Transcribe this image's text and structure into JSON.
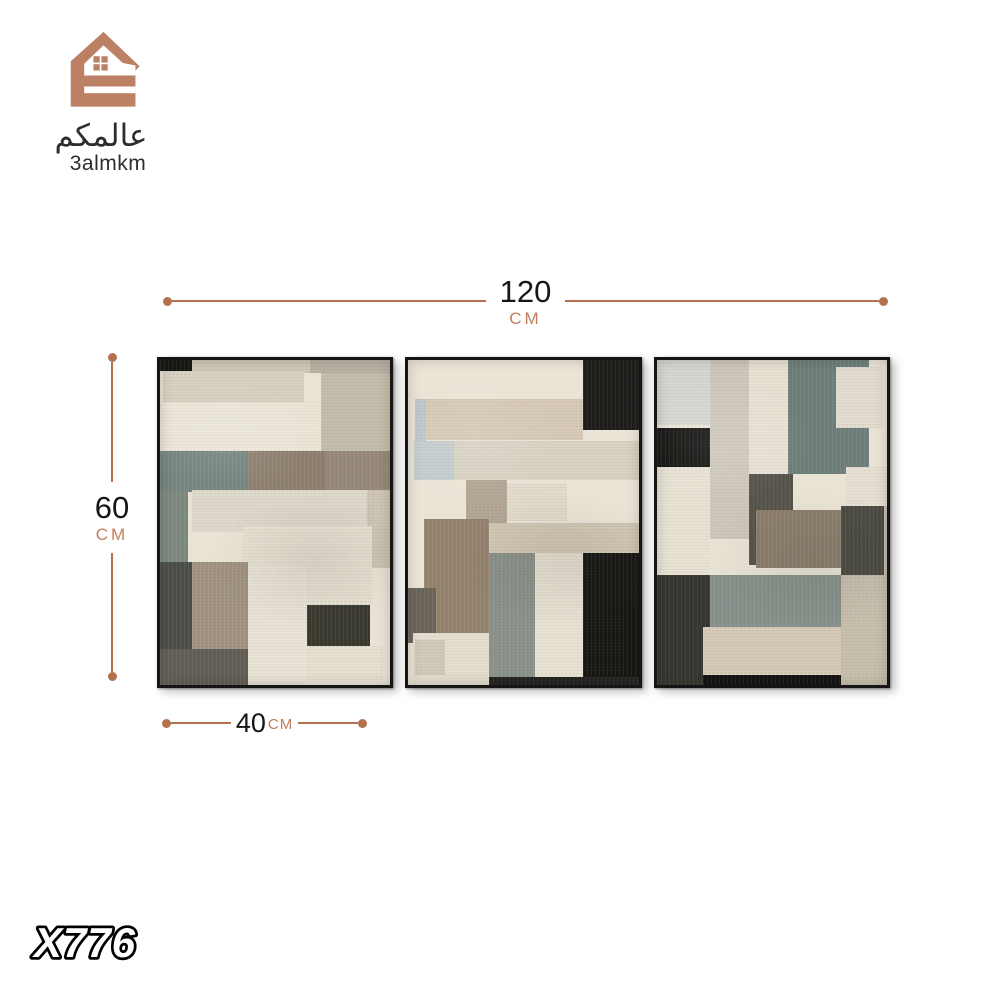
{
  "brand": {
    "logo_arabic": "عالمكم",
    "logo_latin": "3almkm",
    "logo_color": "#bc8065",
    "text_color": "#2f2d2b"
  },
  "product_code": "X776",
  "dimensions": {
    "line_color": "#b4714e",
    "unit_color": "#bf7f5e",
    "number_color": "#161616",
    "total_width": {
      "value": "120",
      "unit": "CM"
    },
    "height": {
      "value": "60",
      "unit": "CM"
    },
    "panel_width": {
      "value": "40",
      "unit": "CM"
    }
  },
  "artwork": {
    "frame_color": "#151515",
    "panels": [
      {
        "name": "left-panel",
        "bg": "#e8e3d5",
        "blocks": [
          {
            "x": 0,
            "y": 0,
            "w": 14,
            "h": 3.5,
            "c": "#141412"
          },
          {
            "x": 14,
            "y": 0,
            "w": 51,
            "h": 4,
            "c": "#cfc8b7"
          },
          {
            "x": 65,
            "y": 0,
            "w": 35,
            "h": 4,
            "c": "#b8b2a4"
          },
          {
            "x": 1.5,
            "y": 3.5,
            "w": 61,
            "h": 9.5,
            "c": "#d7d0c1"
          },
          {
            "x": 70,
            "y": 4,
            "w": 30,
            "h": 24,
            "c": "#c4bcab"
          },
          {
            "x": 1.5,
            "y": 13,
            "w": 67,
            "h": 15,
            "c": "#eae5d7"
          },
          {
            "x": 0,
            "y": 28,
            "w": 38,
            "h": 12.5,
            "c": "#74837d"
          },
          {
            "x": 38,
            "y": 28,
            "w": 34,
            "h": 12,
            "c": "#8c7e6d"
          },
          {
            "x": 72,
            "y": 28,
            "w": 28,
            "h": 12,
            "c": "#968878"
          },
          {
            "x": 0,
            "y": 40,
            "w": 12,
            "h": 22,
            "c": "#7b897f"
          },
          {
            "x": 14,
            "y": 40,
            "w": 76,
            "h": 13,
            "c": "#ddd8ca"
          },
          {
            "x": 90,
            "y": 40,
            "w": 10,
            "h": 24,
            "c": "#cdc5b4"
          },
          {
            "x": 36,
            "y": 51,
            "w": 56,
            "h": 25,
            "c": "#e6e1d3"
          },
          {
            "x": 0,
            "y": 62,
            "w": 14,
            "h": 27,
            "c": "#4b4e46"
          },
          {
            "x": 14,
            "y": 62,
            "w": 24,
            "h": 27,
            "c": "#a09280"
          },
          {
            "x": 38,
            "y": 63,
            "w": 26,
            "h": 37,
            "c": "#e8e3d5"
          },
          {
            "x": 64,
            "y": 75.5,
            "w": 27,
            "h": 12.5,
            "c": "#39382f"
          },
          {
            "x": 64,
            "y": 88,
            "w": 33,
            "h": 10.5,
            "c": "#e4dfd0"
          },
          {
            "x": 0,
            "y": 89,
            "w": 38,
            "h": 11,
            "c": "#615e56"
          }
        ]
      },
      {
        "name": "center-panel",
        "bg": "#e9e4d6",
        "blocks": [
          {
            "x": 76,
            "y": 0,
            "w": 24,
            "h": 21.5,
            "c": "#1d1c1a"
          },
          {
            "x": 6,
            "y": 12,
            "w": 70,
            "h": 12.5,
            "c": "#d6c9b4"
          },
          {
            "x": 3,
            "y": 12,
            "w": 4.5,
            "h": 25,
            "c": "#bdc6ca"
          },
          {
            "x": 2.5,
            "y": 25,
            "w": 17.5,
            "h": 12,
            "c": "#c3ccce"
          },
          {
            "x": 20,
            "y": 25,
            "w": 80,
            "h": 12,
            "c": "#d8d2c3"
          },
          {
            "x": 25,
            "y": 37,
            "w": 18,
            "h": 13.5,
            "c": "#b2a693"
          },
          {
            "x": 43,
            "y": 38,
            "w": 26,
            "h": 11.5,
            "c": "#e0dbcd"
          },
          {
            "x": 25,
            "y": 50,
            "w": 75,
            "h": 9.5,
            "c": "#d2c7b4"
          },
          {
            "x": 7,
            "y": 49,
            "w": 28,
            "h": 35,
            "c": "#94826c"
          },
          {
            "x": 0,
            "y": 70,
            "w": 12,
            "h": 17,
            "c": "#6a6459"
          },
          {
            "x": 35,
            "y": 59.5,
            "w": 20,
            "h": 40.5,
            "c": "#8a9188"
          },
          {
            "x": 55,
            "y": 59.5,
            "w": 21,
            "h": 38,
            "c": "#e7e2d4"
          },
          {
            "x": 76,
            "y": 59.5,
            "w": 24,
            "h": 40.5,
            "c": "#161614"
          },
          {
            "x": 2,
            "y": 84,
            "w": 33,
            "h": 16,
            "c": "#e3decf"
          },
          {
            "x": 3,
            "y": 86,
            "w": 13,
            "h": 11,
            "c": "#cfc9bb"
          },
          {
            "x": 35,
            "y": 97.5,
            "w": 65,
            "h": 2.5,
            "c": "#22211e"
          }
        ]
      },
      {
        "name": "right-panel",
        "bg": "#e8e3d5",
        "blocks": [
          {
            "x": 0,
            "y": 0,
            "w": 23,
            "h": 20,
            "c": "#d5d5d1"
          },
          {
            "x": 23,
            "y": 0,
            "w": 17,
            "h": 55,
            "c": "#cdc7bb"
          },
          {
            "x": 40,
            "y": 0,
            "w": 17,
            "h": 35,
            "c": "#e6e1d3"
          },
          {
            "x": 57,
            "y": 0,
            "w": 35,
            "h": 35,
            "c": "#6d7e7a"
          },
          {
            "x": 78,
            "y": 2,
            "w": 20,
            "h": 19,
            "c": "#e1dcce"
          },
          {
            "x": 0,
            "y": 21,
            "w": 23,
            "h": 12,
            "c": "#131311"
          },
          {
            "x": 0,
            "y": 33,
            "w": 23,
            "h": 33,
            "c": "#e7e2d4"
          },
          {
            "x": 40,
            "y": 35,
            "w": 19,
            "h": 28,
            "c": "#55524a"
          },
          {
            "x": 43,
            "y": 46,
            "w": 39,
            "h": 18,
            "c": "#8c7e6d"
          },
          {
            "x": 82,
            "y": 33,
            "w": 18,
            "h": 12,
            "c": "#e4dfd1"
          },
          {
            "x": 80,
            "y": 45,
            "w": 18.5,
            "h": 21,
            "c": "#4a4a43"
          },
          {
            "x": 98.5,
            "y": 45,
            "w": 1.5,
            "h": 21,
            "c": "#c8bfae"
          },
          {
            "x": 78,
            "y": 66,
            "w": 22,
            "h": 34,
            "c": "#c7beac"
          },
          {
            "x": 0,
            "y": 66,
            "w": 23,
            "h": 34,
            "c": "#35342e"
          },
          {
            "x": 23,
            "y": 66,
            "w": 57,
            "h": 17,
            "c": "#86908a"
          },
          {
            "x": 20,
            "y": 82,
            "w": 60,
            "h": 15,
            "c": "#d4c9b6"
          },
          {
            "x": 20,
            "y": 97,
            "w": 60,
            "h": 3,
            "c": "#121211"
          }
        ]
      }
    ]
  }
}
